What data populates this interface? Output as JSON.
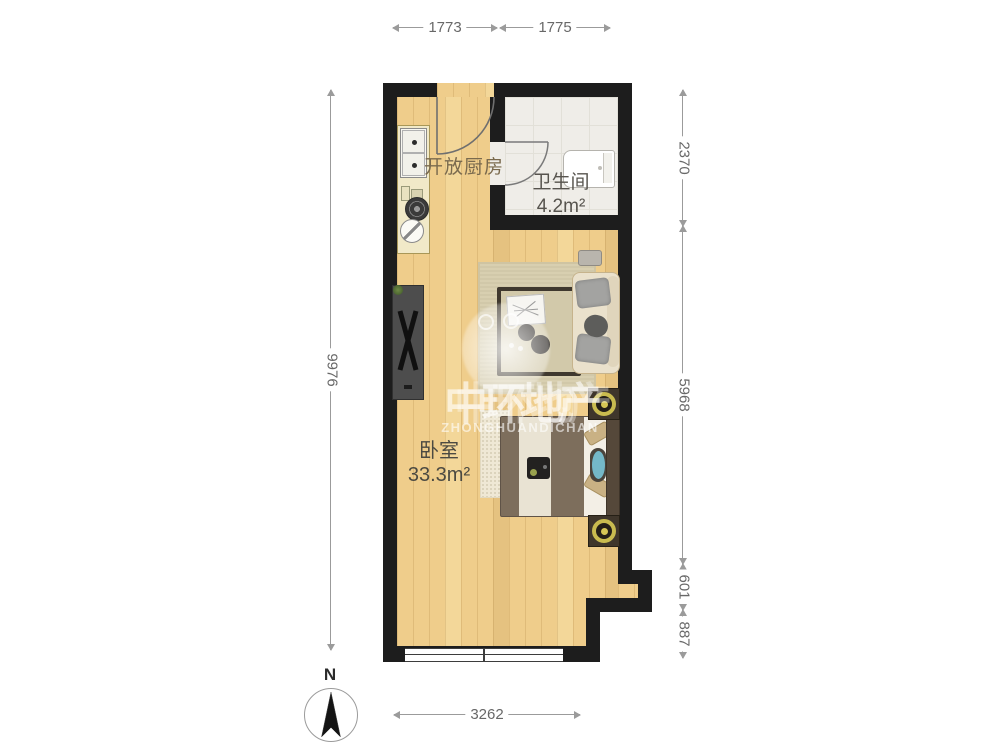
{
  "plan": {
    "rooms": [
      {
        "name": "开放厨房",
        "area": ""
      },
      {
        "name": "卫生间",
        "area": "4.2m²"
      },
      {
        "name": "卧室",
        "area": "33.3m²"
      }
    ]
  },
  "dimensions": {
    "top": [
      "1773",
      "1775"
    ],
    "right": [
      "2370",
      "5968",
      "601",
      "887"
    ],
    "left": [
      "9976"
    ],
    "bottom": [
      "3262"
    ]
  },
  "compass": {
    "north_label": "N"
  },
  "watermark": {
    "line_cn": "中环地产",
    "line_en": "ZHONGHUANDICHAN"
  },
  "colors": {
    "wall": "#1d1d1d",
    "wood_floor": "#efcd8b",
    "tile_floor": "#efede8",
    "dimension_line": "#9b9b9b",
    "dimension_text": "#686868",
    "lamp_gold": "#c9bb4f"
  }
}
